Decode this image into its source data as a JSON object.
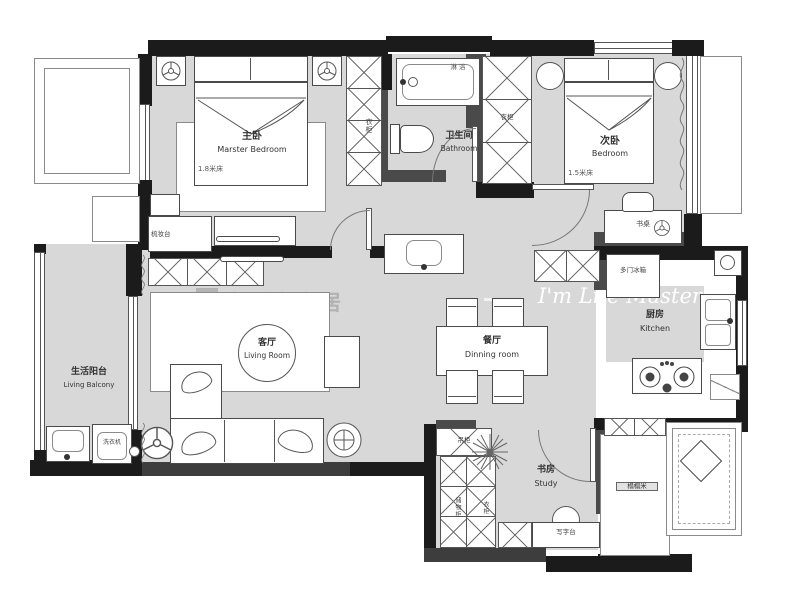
{
  "watermark": {
    "brand_cn": "生活家家居",
    "brand_en": "I'm Life Master"
  },
  "rooms": {
    "master_bedroom": {
      "cn": "主卧",
      "en": "Marster Bedroom",
      "bed": "1.8米床"
    },
    "bathroom": {
      "cn": "卫生间",
      "en": "Bathroom"
    },
    "second_bedroom": {
      "cn": "次卧",
      "en": "Bedroom",
      "bed": "1.5米床"
    },
    "kitchen": {
      "cn": "厨房",
      "en": "Kitchen"
    },
    "dining_room": {
      "cn": "餐厅",
      "en": "Dinning room"
    },
    "living_room": {
      "cn": "客厅",
      "en": "Living Room"
    },
    "living_balcony": {
      "cn": "生活阳台",
      "en": "Living Balcony"
    },
    "study": {
      "cn": "书房",
      "en": "Study"
    }
  },
  "furniture_labels": {
    "wardrobe": "衣柜",
    "dresser": "梳妆台",
    "desk": "书桌",
    "fridge": "多门冰箱",
    "washing_machine": "洗衣机",
    "writing_desk": "写字台",
    "storage_cabinet": "储物柜",
    "hanging_cabinet": "吊柜",
    "tatami": "榻榻米",
    "shower": "淋浴"
  },
  "colors": {
    "wall": "#1b1b1b",
    "floor": "#d8d8d8",
    "line": "#555555"
  }
}
